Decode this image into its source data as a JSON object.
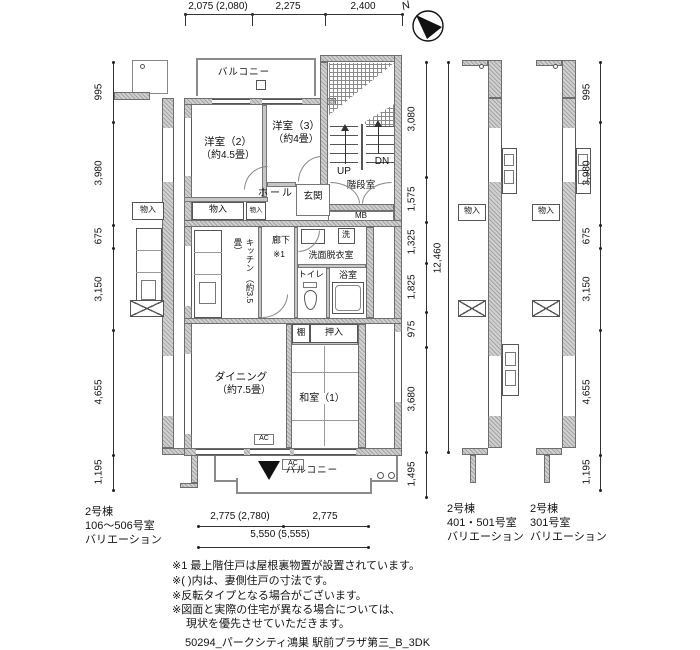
{
  "compass": {
    "north_label": "N"
  },
  "dims": {
    "top": [
      "2,075 (2,080)",
      "2,275",
      "2,400"
    ],
    "left": [
      "995",
      "3,980",
      "675",
      "3,150",
      "4,655",
      "1,195"
    ],
    "mid": [
      "3,080",
      "1,575",
      "1,325",
      "1,825",
      "975",
      "3,680"
    ],
    "mid_total": "12,460",
    "mid_bottom": "1,495",
    "right": [
      "995",
      "3,980",
      "675",
      "3,150",
      "4,655",
      "1,195"
    ],
    "bottom": [
      "2,775 (2,780)",
      "2,775"
    ],
    "bottom_total": "5,550 (5,555)"
  },
  "plan": {
    "balcony_top": "バルコニー",
    "yoshitsu2": "洋室（2）",
    "yoshitsu2_size": "（約4.5畳）",
    "yoshitsu3": "洋室（3）",
    "yoshitsu3_size": "（約4畳）",
    "hall": "ホール",
    "genkan": "玄関",
    "kaidanshitsu": "階段室",
    "up": "UP",
    "dn": "DN",
    "mb": "MB",
    "monoire1": "物入",
    "monoire2": "物入",
    "kitchen": "キッチン",
    "kitchen_size": "（約3.5畳）",
    "rouka": "廊下",
    "rouka_note": "※1",
    "senmen": "洗面脱衣室",
    "sen": "洗",
    "toilet": "トイレ",
    "bath": "浴室",
    "tana": "棚",
    "oshiire": "押入",
    "dining": "ダイニング",
    "dining_size": "（約7.5畳）",
    "washitsu1": "和室（1）",
    "balcony_bottom": "バルコニー",
    "ac1": "AC",
    "ac2": "AC"
  },
  "strips": {
    "left_monoire": "物入",
    "right1_monoire": "物入",
    "right2_monoire": "物入"
  },
  "captions": {
    "left": [
      "2号棟",
      "106〜506号室",
      "バリエーション"
    ],
    "right1": [
      "2号棟",
      "401・501号室",
      "バリエーション"
    ],
    "right2": [
      "2号棟",
      "301号室",
      "バリエーション"
    ]
  },
  "notes": [
    "※1 最上階住戸は屋根裏物置が設置されています。",
    "※( )内は、妻側住戸の寸法です。",
    "※反転タイプとなる場合がございます。",
    "※図面と実際の住宅が異なる場合については、",
    "現状を優先させていただきます。"
  ],
  "footer_title": "50294_パークシティ鴻巣 駅前プラザ第三_B_3DK"
}
